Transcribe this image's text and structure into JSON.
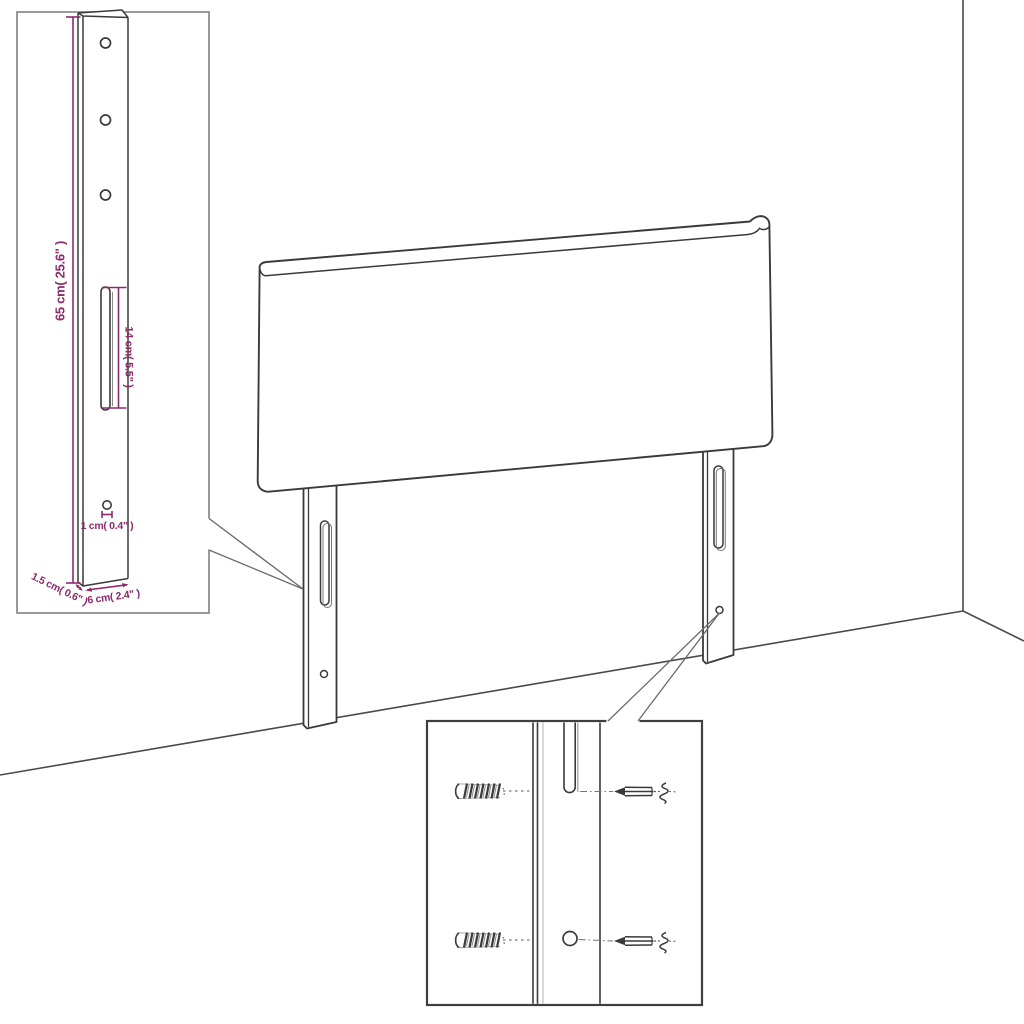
{
  "diagram": {
    "kind": "furniture-assembly-dimension-diagram",
    "subject": "upholstered headboard with two slotted mounting legs, wall corner perspective",
    "colors": {
      "background": "#ffffff",
      "outline": "#3a3a3a",
      "aux_line": "#8a8a8a",
      "dimension_accent": "#8b2b6e",
      "inset_border_light": "#8f8f8f",
      "inset_border_dark": "#3f3f3f"
    },
    "dimensions": {
      "leg_height": "65 cm( 25.6\" )",
      "slot_length": "14 cm( 5.5\" )",
      "hole_diameter": "1 cm( 0.4\" )",
      "side_thickness": "1.5 cm( 0.6\" )",
      "leg_width": "6 cm( 2.4\" )"
    },
    "insets": {
      "leg_detail": "enlarged leg with three holes, long slot and bottom measurements",
      "mounting_detail": "screws and wall plugs aligned with leg slot and hole"
    }
  }
}
